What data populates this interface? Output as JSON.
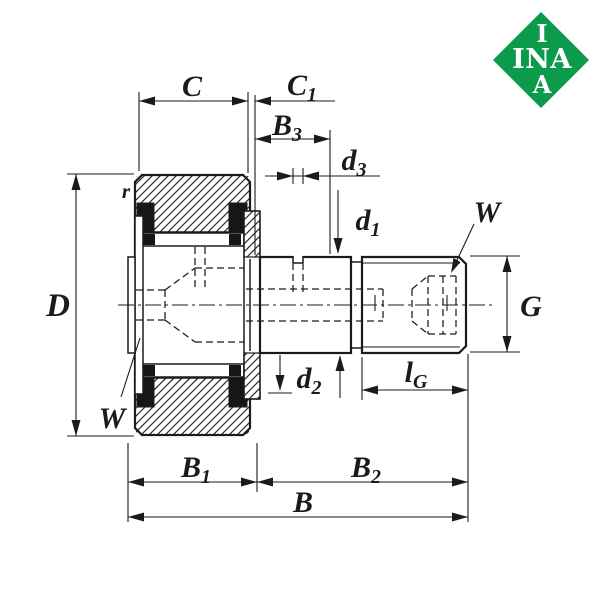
{
  "logo": {
    "line1": "I",
    "line2": "INA",
    "line3": "A"
  },
  "drawing": {
    "colors": {
      "line": "#1b1b1b",
      "logo_green": "#0c9a4d",
      "seal_black": "#161616"
    },
    "dims": {
      "C": "C",
      "C1_base": "C",
      "C1_sub": "1",
      "B3_base": "B",
      "B3_sub": "3",
      "d3_base": "d",
      "d3_sub": "3",
      "d1_base": "d",
      "d1_sub": "1",
      "d2_base": "d",
      "d2_sub": "2",
      "D": "D",
      "r": "r",
      "W_roller": "W",
      "W_stud": "W",
      "G": "G",
      "lG_base": "l",
      "lG_sub": "G",
      "B1_base": "B",
      "B1_sub": "1",
      "B2_base": "B",
      "B2_sub": "2",
      "B": "B"
    }
  }
}
